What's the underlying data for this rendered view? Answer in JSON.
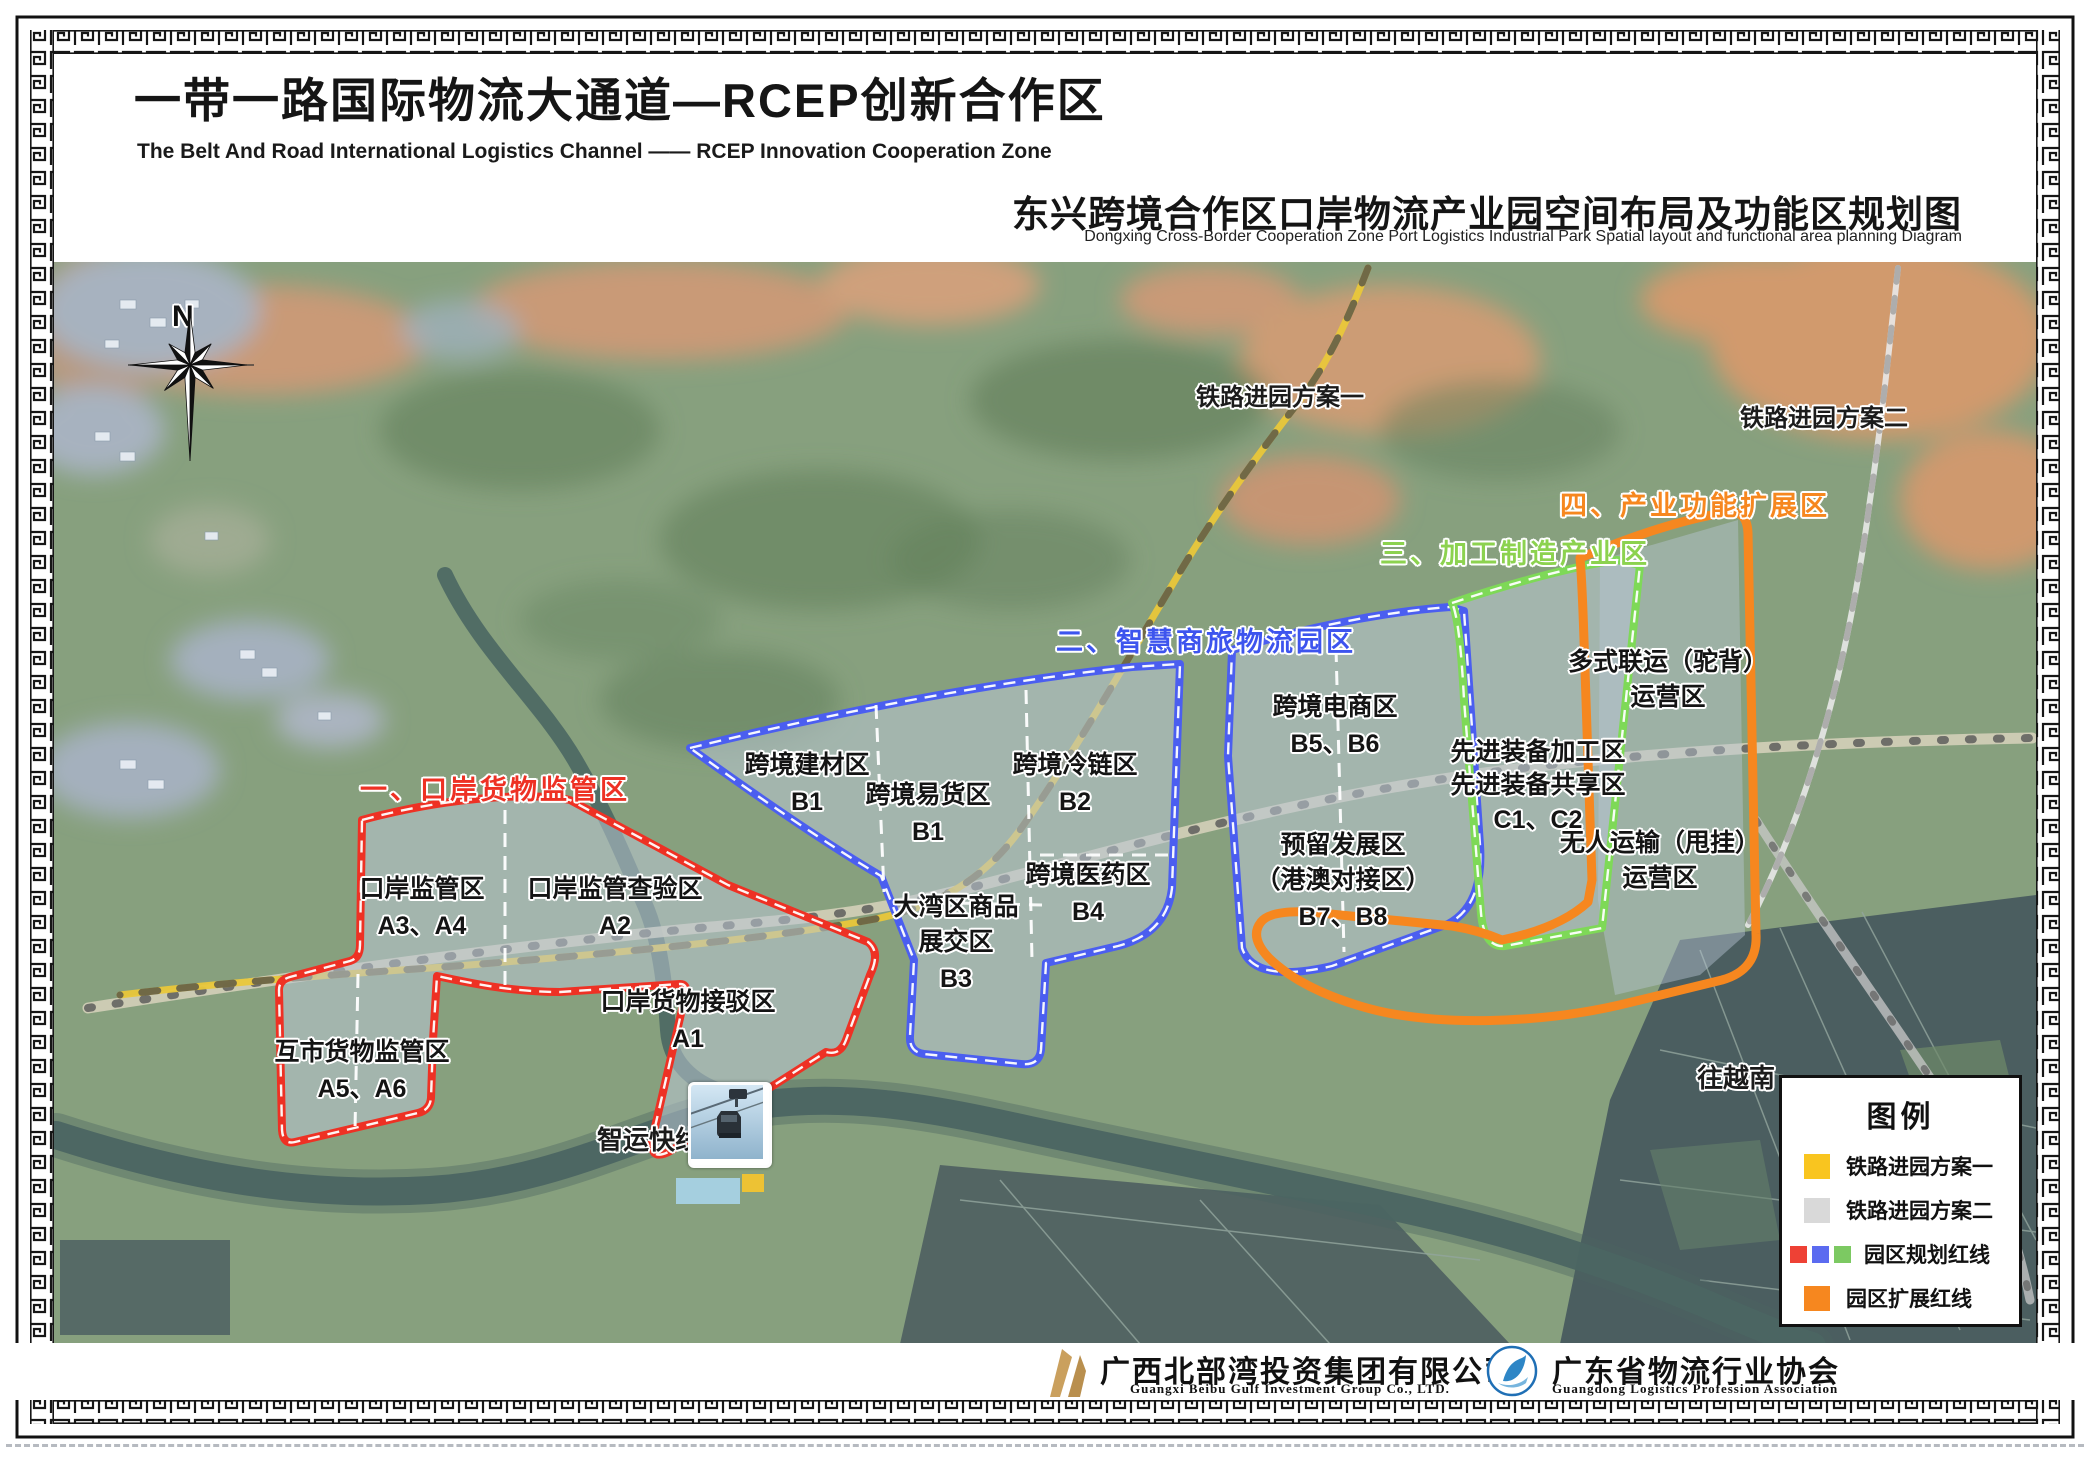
{
  "header": {
    "title_cn": "一带一路国际物流大通道—RCEP创新合作区",
    "title_en": "The Belt And Road International Logistics Channel —— RCEP Innovation Cooperation Zone",
    "subtitle_cn": "东兴跨境合作区口岸物流产业园空间布局及功能区规划图",
    "subtitle_en": "Dongxing Cross-Border Cooperation Zone Port Logistics Industrial Park Spatial layout and functional area planning Diagram"
  },
  "compass": {
    "label": "N"
  },
  "map": {
    "labels": {
      "railway_plan1": "铁路进园方案一",
      "railway_plan2": "铁路进园方案二",
      "smart_transit": "智运快线",
      "to_vietnam": "往越南"
    },
    "zones": [
      {
        "title": "一、口岸货物监管区",
        "color": "#ee3124",
        "subzones": [
          {
            "name": "口岸监管区",
            "code": "A3、A4"
          },
          {
            "name": "口岸监管查验区",
            "code": "A2"
          },
          {
            "name": "口岸货物接驳区",
            "code": "A1"
          },
          {
            "name": "互市货物监管区",
            "code": "A5、A6"
          }
        ]
      },
      {
        "title": "二、智慧商旅物流园区",
        "color": "#3d54ee",
        "subzones": [
          {
            "name": "跨境建材区",
            "code": "B1"
          },
          {
            "name": "跨境易货区",
            "code": "B1"
          },
          {
            "name": "跨境冷链区",
            "code": "B2"
          },
          {
            "name": "大湾区商品",
            "name2": "展交区",
            "code": "B3"
          },
          {
            "name": "跨境医药区",
            "code": "B4"
          },
          {
            "name": "跨境电商区",
            "code": "B5、B6"
          },
          {
            "name": "预留发展区",
            "name2": "（港澳对接区）",
            "code": "B7、B8"
          }
        ]
      },
      {
        "title": "三、加工制造产业区",
        "color": "#8cd24f",
        "subzones": [
          {
            "name": "先进装备加工区",
            "name2": "先进装备共享区",
            "code": "C1、C2"
          }
        ]
      },
      {
        "title": "四、产业功能扩展区",
        "color": "#f6871f",
        "subzones": [
          {
            "name": "多式联运（驼背）",
            "name2": "运营区",
            "code": ""
          },
          {
            "name": "无人运输（甩挂）",
            "name2": "运营区",
            "code": ""
          }
        ]
      }
    ]
  },
  "legend": {
    "title": "图例",
    "items": [
      {
        "label": "铁路进园方案一",
        "colors": [
          "#f9c51f"
        ]
      },
      {
        "label": "铁路进园方案二",
        "colors": [
          "#d9d9d9"
        ]
      },
      {
        "label": "园区规划红线",
        "colors": [
          "#ee4135",
          "#5b6bf0",
          "#7cc962"
        ]
      },
      {
        "label": "园区扩展红线",
        "colors": [
          "#f6871f"
        ]
      }
    ]
  },
  "footer": {
    "org1_cn": "广西北部湾投资集团有限公司",
    "org1_en": "Guangxi Beibu Gulf Investment Group Co., LTD.",
    "org2_cn": "广东省物流行业协会",
    "org2_en": "Guangdong Logistics Profession Association"
  }
}
